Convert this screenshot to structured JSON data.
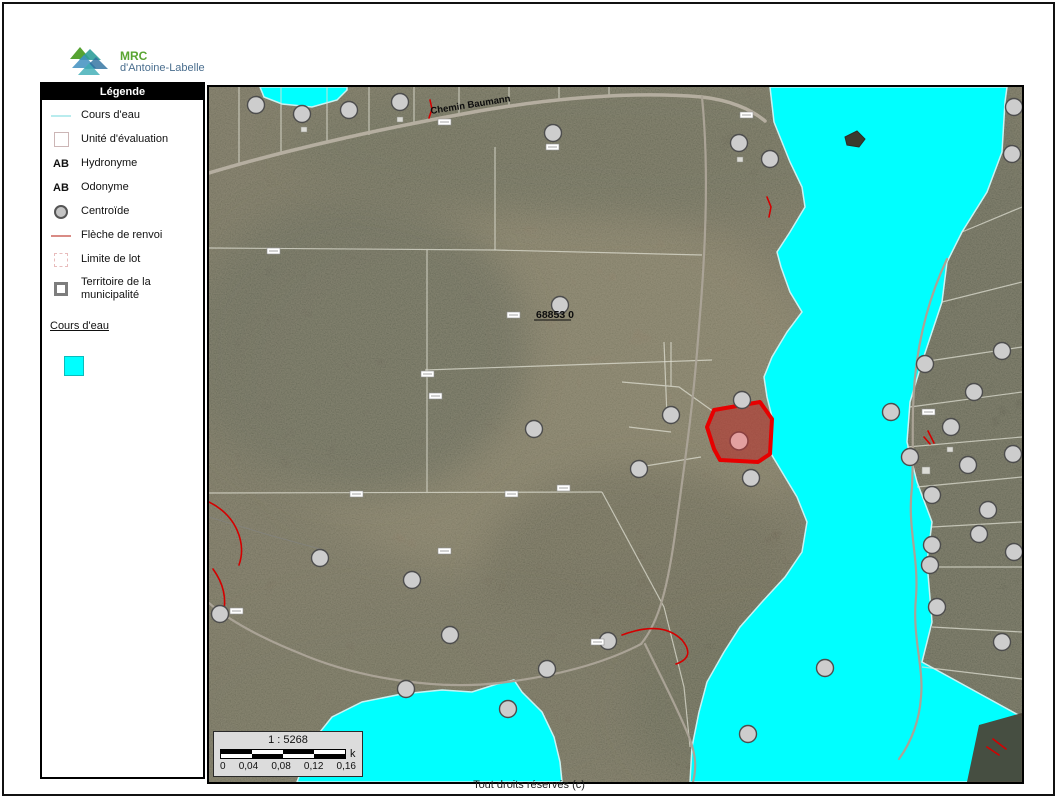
{
  "logo": {
    "acronym": "MRC",
    "name": "d'Antoine-Labelle"
  },
  "legend": {
    "title": "Légende",
    "items": [
      {
        "label": "Cours d'eau"
      },
      {
        "label": "Unité d'évaluation"
      },
      {
        "label": "Hydronyme",
        "swatch_text": "AB"
      },
      {
        "label": "Odonyme",
        "swatch_text": "AB"
      },
      {
        "label": "Centroïde"
      },
      {
        "label": "Flèche de renvoi"
      },
      {
        "label": "Limite de lot"
      },
      {
        "label": "Territoire de la municipalité"
      }
    ],
    "layer_link": "Cours d'eau",
    "layer_swatch_color": "#00FFFF"
  },
  "map": {
    "road_label": "Chemin Baumann",
    "parcel_label": "68853 0",
    "scalebar": {
      "ratio": "1 : 5268",
      "unit": "k",
      "ticks": [
        "0",
        "0,04",
        "0,08",
        "0,12",
        "0,16"
      ]
    },
    "colors": {
      "water": "#00FFFF",
      "selection": "#E60000"
    },
    "centroids": [
      [
        47,
        18
      ],
      [
        93,
        27
      ],
      [
        140,
        23
      ],
      [
        191,
        15
      ],
      [
        344,
        46
      ],
      [
        530,
        56
      ],
      [
        561,
        72
      ],
      [
        805,
        20
      ],
      [
        803,
        67
      ],
      [
        351,
        218
      ],
      [
        325,
        342
      ],
      [
        430,
        382
      ],
      [
        462,
        328
      ],
      [
        533,
        313
      ],
      [
        542,
        391
      ],
      [
        716,
        277
      ],
      [
        793,
        264
      ],
      [
        682,
        325
      ],
      [
        765,
        305
      ],
      [
        742,
        340
      ],
      [
        701,
        370
      ],
      [
        759,
        378
      ],
      [
        804,
        367
      ],
      [
        723,
        408
      ],
      [
        779,
        423
      ],
      [
        770,
        447
      ],
      [
        723,
        458
      ],
      [
        721,
        478
      ],
      [
        805,
        465
      ],
      [
        728,
        520
      ],
      [
        793,
        555
      ],
      [
        111,
        471
      ],
      [
        203,
        493
      ],
      [
        241,
        548
      ],
      [
        11,
        527
      ],
      [
        197,
        602
      ],
      [
        399,
        554
      ],
      [
        338,
        582
      ],
      [
        299,
        622
      ],
      [
        539,
        647
      ],
      [
        616,
        581
      ]
    ],
    "selected_centroid": [
      530,
      354
    ],
    "lot_boxes": [
      [
        58,
        161
      ],
      [
        229,
        32
      ],
      [
        337,
        57
      ],
      [
        212,
        284
      ],
      [
        220,
        306
      ],
      [
        296,
        404
      ],
      [
        141,
        404
      ],
      [
        229,
        461
      ],
      [
        348,
        398
      ],
      [
        21,
        521
      ],
      [
        382,
        552
      ],
      [
        531,
        25
      ],
      [
        713,
        322
      ],
      [
        298,
        225
      ]
    ]
  },
  "footer": {
    "copyright": "Tout droits réservés (c)"
  }
}
